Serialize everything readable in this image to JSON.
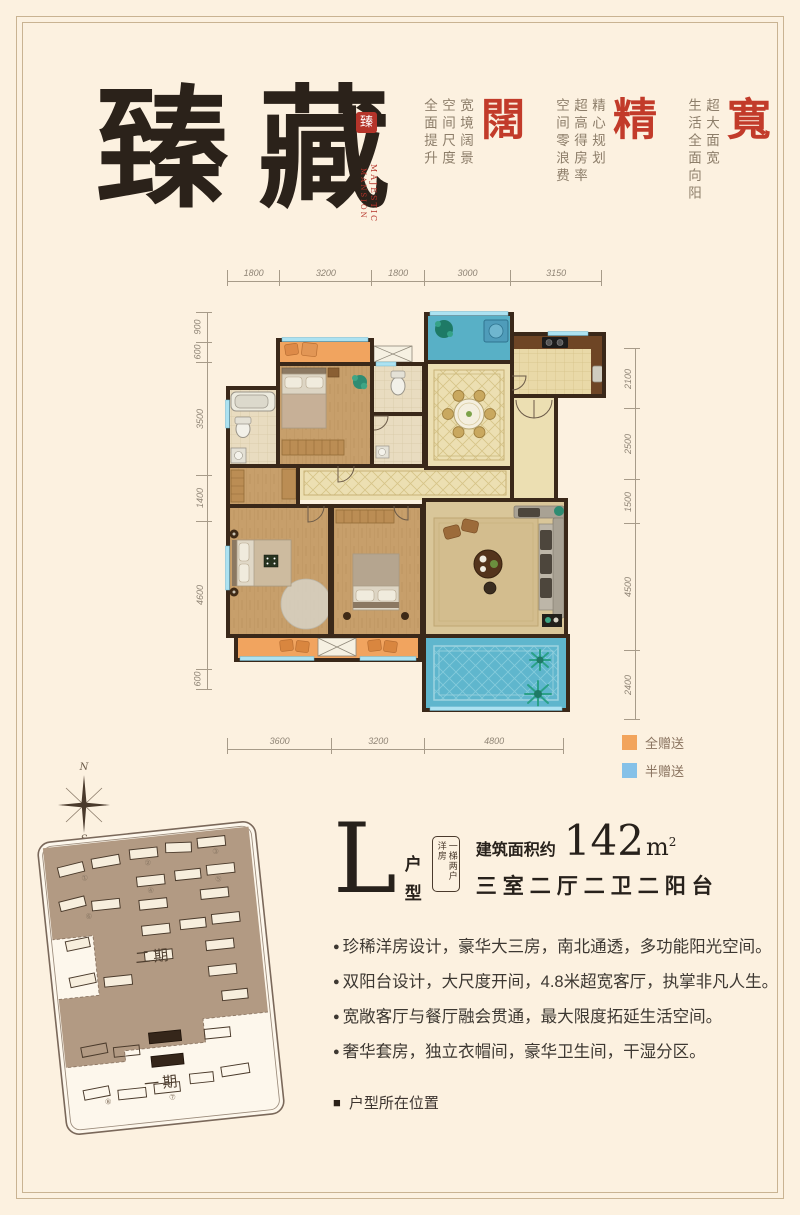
{
  "page": {
    "background": "#fcf1e0",
    "frame_color": "#c9b392"
  },
  "header": {
    "title_char1": "臻",
    "title_char2": "藏",
    "seal_char": "臻",
    "seal_vertical_right": "MAJESTIC",
    "seal_vertical_left": "MANSION",
    "accent_red": "#c23b2a",
    "features": [
      {
        "big": "闊",
        "cols": [
          "宽境阔景",
          "空间尺度",
          "全面提升"
        ]
      },
      {
        "big": "精",
        "cols": [
          "精心规划",
          "超高得房率",
          "空间零浪费"
        ]
      },
      {
        "big": "寬",
        "cols": [
          "超大面宽",
          "生活全面向阳"
        ]
      }
    ]
  },
  "plan": {
    "dims_top": [
      "1800",
      "3200",
      "1800",
      "3000",
      "3150"
    ],
    "dims_left": [
      "900",
      "600",
      "3500",
      "1400",
      "4600",
      "600"
    ],
    "dims_right": [
      "2100",
      "2500",
      "1500",
      "4500",
      "2400"
    ],
    "dims_bottom": [
      "3600",
      "3200",
      "4800"
    ],
    "legend": [
      {
        "label": "全赠送",
        "color": "#f2a45c"
      },
      {
        "label": "半赠送",
        "color": "#85c1e8"
      }
    ]
  },
  "site": {
    "compass_n": "N",
    "compass_s": "S",
    "phase2_label": "二期",
    "phase1_label": "一期",
    "markers": [
      "①",
      "②",
      "③",
      "④",
      "⑤",
      "⑥",
      "⑦",
      "⑧"
    ]
  },
  "unit": {
    "letter": "L",
    "type_char1": "户",
    "type_char2": "型",
    "stamp": "一梯两户洋房",
    "area_prefix": "建筑面积约",
    "area_value": "142",
    "area_unit": "m",
    "area_sup": "2",
    "layout_label": "三室二厅二卫二阳台",
    "bullet_marker": "●",
    "bullets": [
      "珍稀洋房设计，豪华大三房，南北通透，多功能阳光空间。",
      "双阳台设计，大尺度开间，4.8米超宽客厅，执掌非凡人生。",
      "宽敞客厅与餐厅融会贯通，最大限度拓延生活空间。",
      "奢华套房，独立衣帽间，豪华卫生间，干湿分区。"
    ],
    "footer_marker": "■",
    "footer_label": "户型所在位置"
  }
}
